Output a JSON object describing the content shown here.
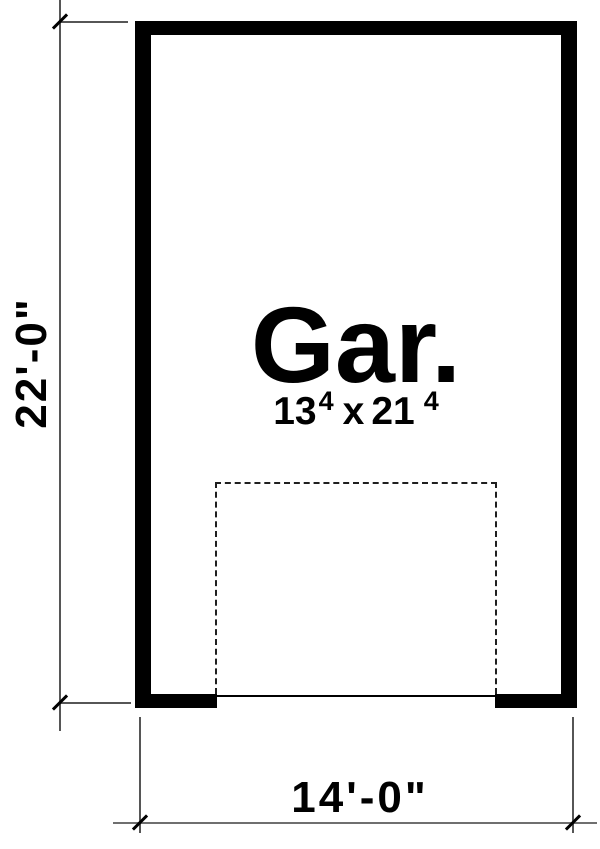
{
  "plan": {
    "type": "garage-floor-plan",
    "room": {
      "label": "Gar.",
      "size": {
        "width_feet": "13",
        "width_inches_sup": "4",
        "separator": "x",
        "length_feet": "21",
        "length_inches_sup": "4"
      }
    },
    "dimensions": {
      "left_vertical": "22'-0\"",
      "bottom_horizontal": "14'-0\""
    },
    "features": {
      "garage_door_outline": "dashed-rectangle",
      "garage_door_opening": "bottom-wall"
    },
    "colors": {
      "background": "#ffffff",
      "wall": "#000000",
      "text": "#000000",
      "dimension_line": "#6f6f6f",
      "extension_line": "#565656",
      "tick": "#000000",
      "dashed_outline": "#1f1f1f"
    }
  }
}
